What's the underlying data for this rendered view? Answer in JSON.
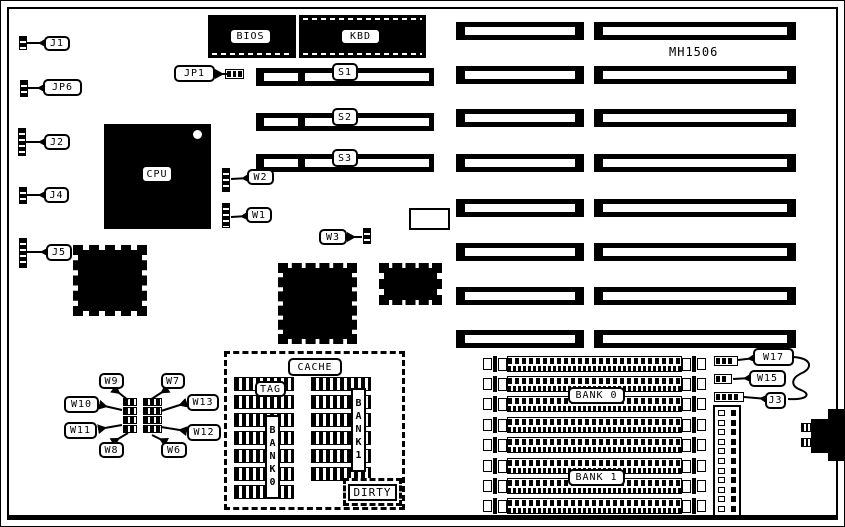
{
  "diagram": {
    "model_label": "MH1506",
    "chips": {
      "bios": "BIOS",
      "kbd": "KBD",
      "cpu": "CPU"
    },
    "cache": {
      "title": "CACHE",
      "tag": "TAG",
      "bank0_vertical": "BANK0",
      "bank1_vertical": "BANK1",
      "dirty": "DIRTY"
    },
    "slots": {
      "s1": "S1",
      "s2": "S2",
      "s3": "S3"
    },
    "memory_banks": {
      "bank0": "BANK 0",
      "bank1": "BANK 1"
    },
    "jumpers": {
      "j1": "J1",
      "jp6": "JP6",
      "j2": "J2",
      "j4": "J4",
      "j5": "J5",
      "jp1": "JP1",
      "w1": "W1",
      "w2": "W2",
      "w3": "W3",
      "w6": "W6",
      "w7": "W7",
      "w8": "W8",
      "w9": "W9",
      "w10": "W10",
      "w11": "W11",
      "w12": "W12",
      "w13": "W13",
      "w15": "W15",
      "w17": "W17",
      "j3": "J3"
    },
    "colors": {
      "foreground": "#000000",
      "background": "#ffffff"
    }
  }
}
